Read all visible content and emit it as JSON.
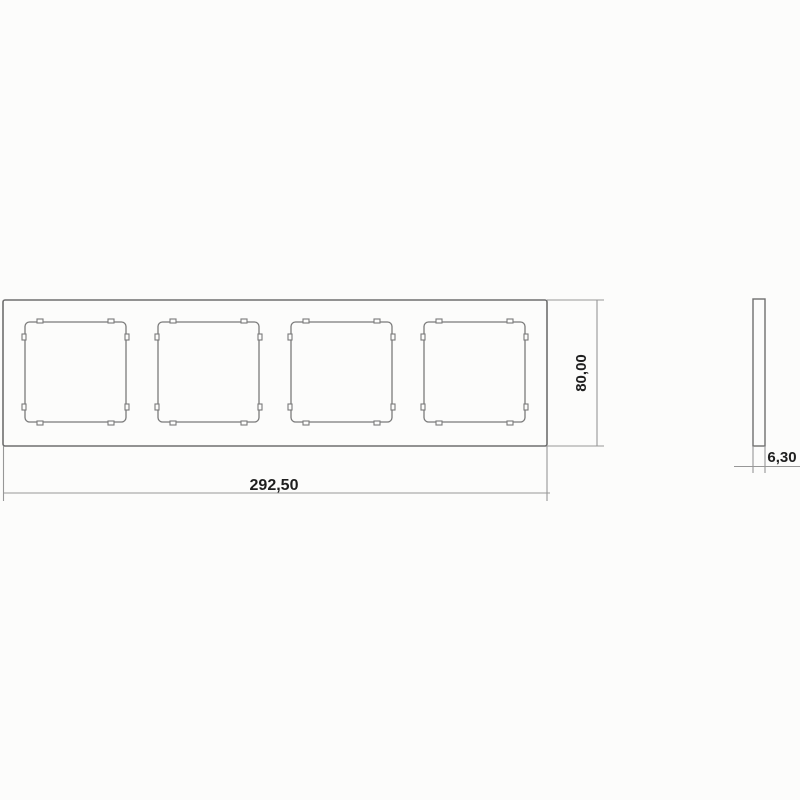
{
  "drawing": {
    "front_view": {
      "name": "four-gang frame front view",
      "openings_count": 4
    },
    "side_view": {
      "name": "frame profile side view"
    }
  },
  "dimensions": {
    "width": {
      "label": "292,50"
    },
    "height": {
      "label": "80,00"
    },
    "thickness": {
      "label": "6,30"
    }
  },
  "colors": {
    "object_line": "#6f6f6f",
    "opening_line": "#7a7a7a",
    "dimension_line": "#979797",
    "text": "#1f1f1f",
    "background": "#fcfcfb"
  }
}
